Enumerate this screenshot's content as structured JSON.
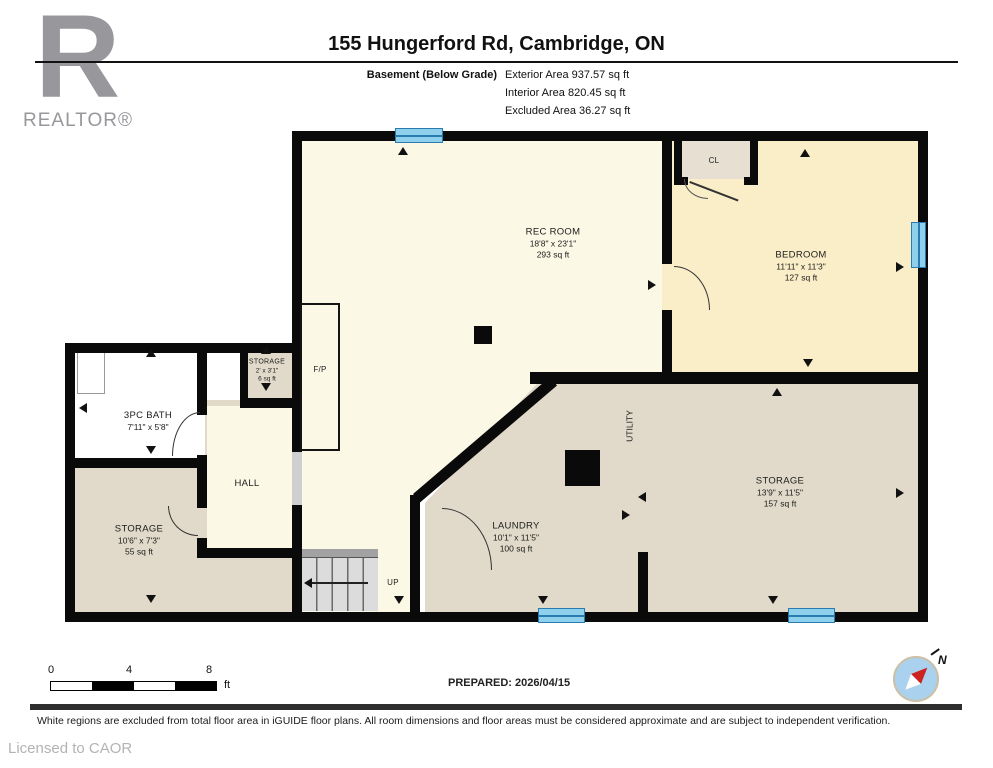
{
  "header": {
    "title": "155 Hungerford Rd, Cambridge, ON",
    "floor_label": "Basement (Below Grade)",
    "exterior_area": "Exterior Area 937.57 sq ft",
    "interior_area": "Interior Area 820.45 sq ft",
    "excluded_area": "Excluded Area 36.27 sq ft"
  },
  "logo": {
    "letter": "R",
    "text": "REALTOR®"
  },
  "rooms": {
    "rec_room": {
      "name": "REC ROOM",
      "dims": "18'8\" x 23'1\"",
      "area": "293 sq ft"
    },
    "bedroom": {
      "name": "BEDROOM",
      "dims": "11'11\" x 11'3\"",
      "area": "127 sq ft"
    },
    "closet": {
      "name": "CL"
    },
    "bath": {
      "name": "3PC BATH",
      "dims": "7'11\" x 5'8\""
    },
    "storage_small": {
      "name": "STORAGE",
      "dims": "2' x 3'1\"",
      "area": "6 sq ft"
    },
    "fireplace": {
      "name": "F/P"
    },
    "hall": {
      "name": "HALL"
    },
    "storage_left": {
      "name": "STORAGE",
      "dims": "10'6\" x 7'3\"",
      "area": "55 sq ft"
    },
    "laundry": {
      "name": "LAUNDRY",
      "dims": "10'1\" x 11'5\"",
      "area": "100 sq ft"
    },
    "utility": {
      "name": "UTILITY"
    },
    "storage_right": {
      "name": "STORAGE",
      "dims": "13'9\" x 11'5\"",
      "area": "157 sq ft"
    },
    "stairs": {
      "label": "UP"
    }
  },
  "scale_bar": {
    "tick0": "0",
    "tick1": "4",
    "tick2": "8",
    "unit": "ft"
  },
  "prepared": "PREPARED: 2026/04/15",
  "compass": {
    "label": "N"
  },
  "footer": {
    "disclaimer": "White regions are excluded from total floor area in iGUIDE floor plans. All room dimensions and floor areas must be considered approximate and are subject to independent verification.",
    "license": "Licensed to CAOR"
  },
  "colors": {
    "room_light": "#fcf8e6",
    "room_yellow": "#faeec8",
    "room_beige": "#e1d9c9",
    "wall": "#0a0a0a",
    "window_fill": "#8fd0ec",
    "window_line": "#2a7cb0",
    "compass_fill": "#aad2ee",
    "needle_red": "#cc2222"
  }
}
